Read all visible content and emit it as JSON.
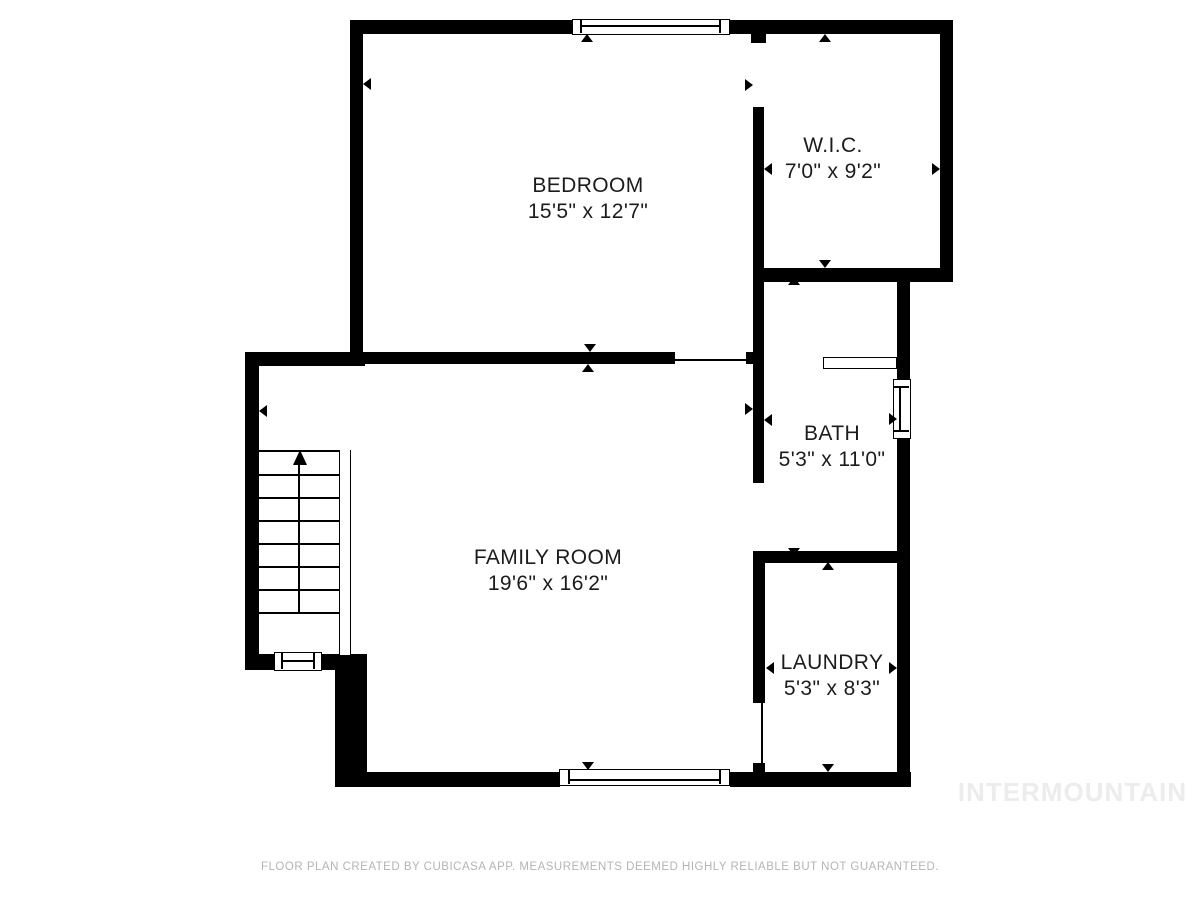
{
  "title": "Floor plan",
  "rooms": {
    "bedroom": {
      "name": "BEDROOM",
      "dims": "15'5\" x 12'7\""
    },
    "wic": {
      "name": "W.I.C.",
      "dims": "7'0\" x 9'2\""
    },
    "bath": {
      "name": "BATH",
      "dims": "5'3\" x 11'0\""
    },
    "family_room": {
      "name": "FAMILY ROOM",
      "dims": "19'6\" x 16'2\""
    },
    "laundry": {
      "name": "LAUNDRY",
      "dims": "5'3\" x 8'3\""
    }
  },
  "watermark": "INTERMOUNTAIN",
  "footer": "FLOOR PLAN CREATED BY CUBICASA APP. MEASUREMENTS DEEMED HIGHLY RELIABLE BUT NOT GUARANTEED.",
  "colors": {
    "wall": "#000000",
    "label": "#1c1c1c",
    "watermark": "#ececec",
    "footer": "#b4b4b4",
    "background": "#ffffff"
  }
}
